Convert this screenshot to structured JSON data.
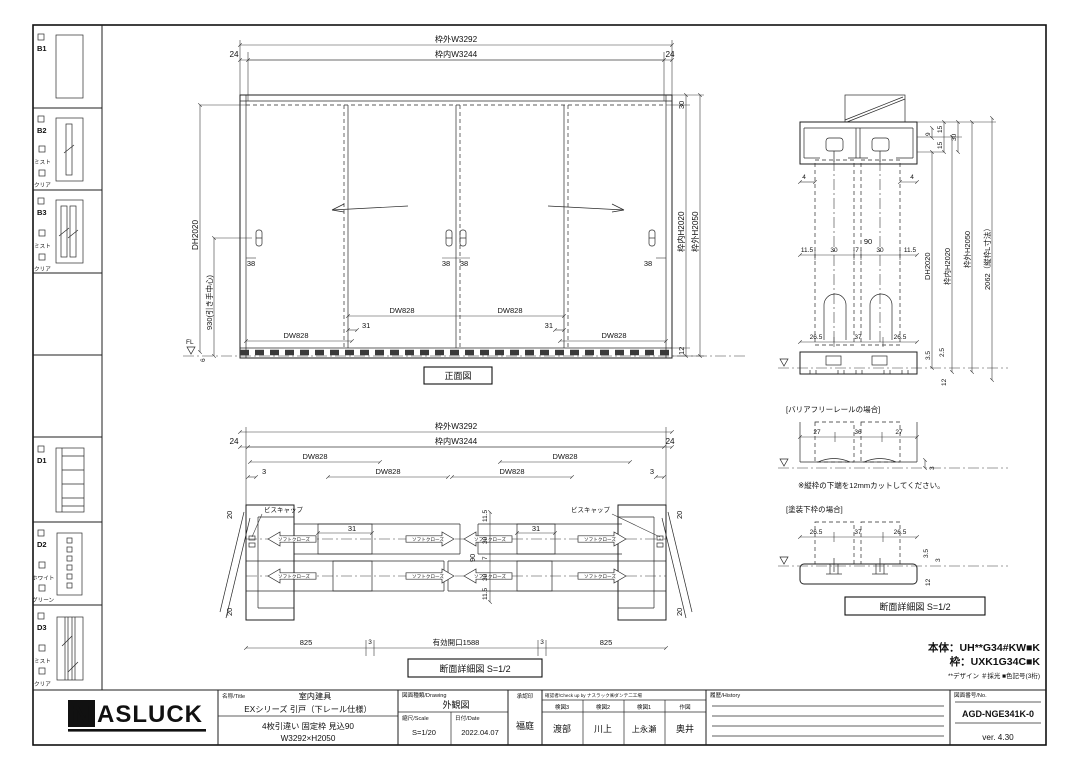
{
  "sidebar": {
    "items": [
      {
        "code": "B1",
        "opts": []
      },
      {
        "code": "B2",
        "opts": [
          "ミスト",
          "クリア"
        ]
      },
      {
        "code": "B3",
        "opts": [
          "ミスト",
          "クリア"
        ]
      },
      {
        "code": "D1",
        "opts": []
      },
      {
        "code": "D2",
        "opts": [
          "ホワイト",
          "グリーン"
        ]
      },
      {
        "code": "D3",
        "opts": [
          "ミスト",
          "クリア"
        ]
      }
    ]
  },
  "front": {
    "caption": "正面図",
    "w_out": "枠外W3292",
    "w_in": "枠内W3244",
    "side": "24",
    "top30": "30",
    "h_in": "枠内H2020",
    "h_out": "枠外H2050",
    "bottom12": "12",
    "six": "6",
    "dh": "DH2020",
    "handle_h": "930(引き手中心)",
    "fl": "FL",
    "dw": "DW828",
    "lap": "31",
    "handle_off": "38"
  },
  "plan": {
    "caption": "断面詳細図 S=1/2",
    "w_out": "枠外W3292",
    "w_in": "枠内W3244",
    "side": "24",
    "three": "3",
    "dw": "DW828",
    "screw_cap": "ビスキャップ",
    "soft_close": "ソフトクローズ",
    "lap": "31",
    "d825": "825",
    "opening": "有効開口1588",
    "v": [
      "11.5",
      "30",
      "7",
      "30",
      "11.5"
    ],
    "v_total": "90",
    "d20": "20"
  },
  "section": {
    "d4": "4",
    "d90": "90",
    "h_chain": [
      "11.5",
      "30",
      "7",
      "30",
      "11.5"
    ],
    "bottom_chain": [
      "26.5",
      "37",
      "26.5"
    ],
    "d9": "9",
    "d15a": "15",
    "d15b": "15",
    "d30": "30",
    "dh": "DH2020",
    "h_in": "枠内H2020",
    "h_out": "枠外H2050",
    "l_dim": "2062（縦枠L寸法）",
    "d35": "3.5",
    "d25": "2.5",
    "d12": "12"
  },
  "barrier": {
    "title": "[バリアフリーレールの場合]",
    "chain": [
      "27",
      "36",
      "27"
    ],
    "d3": "3",
    "note": "※縦枠の下端を12mmカットしてください。"
  },
  "paint": {
    "title": "[塗装下枠の場合]",
    "chain": [
      "26.5",
      "37",
      "26.5"
    ],
    "d35": "3.5",
    "d3": "3",
    "d12": "12",
    "caption": "断面詳細図 S=1/2"
  },
  "codes": {
    "body": "本体：UH**G34#KW■K",
    "frame": "枠：UXK1G34C■K",
    "legend": "**デザイン ＃採光 ■色記号(3桁)"
  },
  "titleblock": {
    "logo_n": "N",
    "logo_rest": "ASLUCK",
    "name_label": "名称/Title",
    "product_category": "室内建具",
    "series": "EXシリーズ 引戸（下レール仕様）",
    "spec": "4枚引違い 固定枠 見込90",
    "size": "W3292×H2050",
    "drawing_label": "図面種類/Drawing",
    "drawing_type": "外観図",
    "scale_label": "縮尺/Scale",
    "scale": "S=1/20",
    "date_label": "日付/Date",
    "date": "2022.04.07",
    "approval_label": "承認印",
    "approval": "福庭",
    "check_label": "確認者/Check up by ナスラック㈱ダンテ二工場",
    "checks": [
      {
        "role": "検図3",
        "name": "渡部"
      },
      {
        "role": "検図2",
        "name": "川上"
      },
      {
        "role": "検図1",
        "name": "上永瀬"
      },
      {
        "role": "作図",
        "name": "奥井"
      }
    ],
    "history_label": "履歴/History",
    "no_label": "図面番号/No.",
    "drawing_no": "AGD-NGE341K-0",
    "version": "ver. 4.30"
  }
}
